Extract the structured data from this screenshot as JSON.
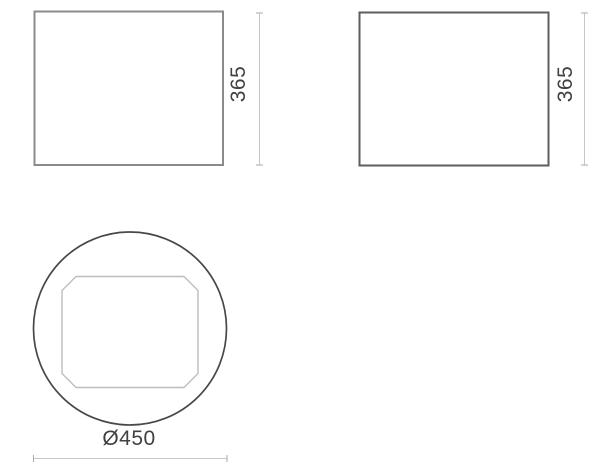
{
  "diagram": {
    "type": "technical-drawing",
    "views": {
      "front": {
        "name": "front view",
        "height_dimension": "365"
      },
      "side": {
        "name": "side view",
        "height_dimension": "365"
      },
      "top": {
        "name": "top view",
        "diameter_dimension": "Ø450"
      }
    },
    "colors": {
      "background": "#ffffff",
      "front_outline": "#8b8b8b",
      "side_outline": "#5d5d5d",
      "circle_outline": "#484848",
      "inner_panel_outline": "#bdbdbd",
      "dimension_line": "#c7c7c7",
      "dimension_tick": "#a9a9a9",
      "dimension_text": "#414141"
    }
  }
}
